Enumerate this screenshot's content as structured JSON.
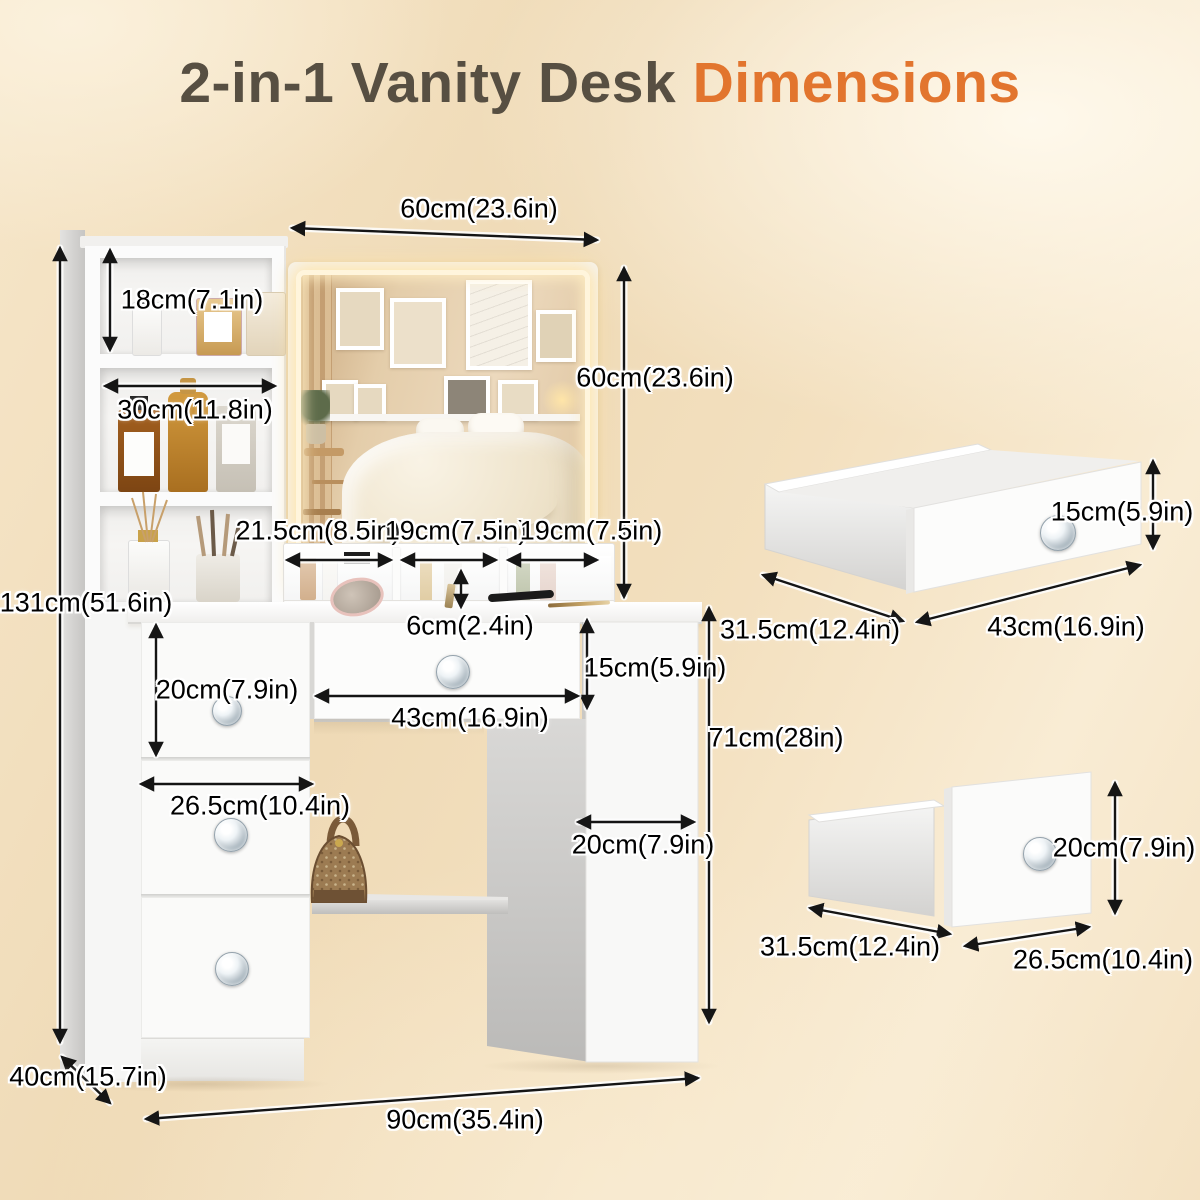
{
  "title": {
    "main": "2-in-1 Vanity Desk ",
    "accent": "Dimensions"
  },
  "colors": {
    "accent_orange": "#e2752e",
    "title_gray": "#574f42",
    "background_beige": "#f3e0bf",
    "arrow_black": "#151515",
    "furniture_white": "#fbfbfb"
  },
  "dimensions": {
    "mirror_width": "60cm(23.6in)",
    "tower_top_shelf_height": "18cm(7.1in)",
    "tower_shelf_width": "30cm(11.8in)",
    "mirror_height": "60cm(23.6in)",
    "organizer_compartment_left": "21.5cm(8.5in)",
    "organizer_compartment_middle": "19cm(7.5in)",
    "organizer_compartment_right": "19cm(7.5in)",
    "organizer_depth": "6cm(2.4in)",
    "left_top_drawer_height": "20cm(7.9in)",
    "center_drawer_height": "15cm(5.9in)",
    "center_drawer_width": "43cm(16.9in)",
    "left_drawer_width": "26.5cm(10.4in)",
    "right_pedestal_width": "20cm(7.9in)",
    "desk_height": "71cm(28in)",
    "overall_height": "131cm(51.6in)",
    "overall_depth": "40cm(15.7in)",
    "overall_width": "90cm(35.4in)",
    "drawer_large": {
      "height": "15cm(5.9in)",
      "depth": "31.5cm(12.4in)",
      "width": "43cm(16.9in)"
    },
    "drawer_small": {
      "height": "20cm(7.9in)",
      "depth": "31.5cm(12.4in)",
      "width": "26.5cm(10.4in)"
    }
  }
}
